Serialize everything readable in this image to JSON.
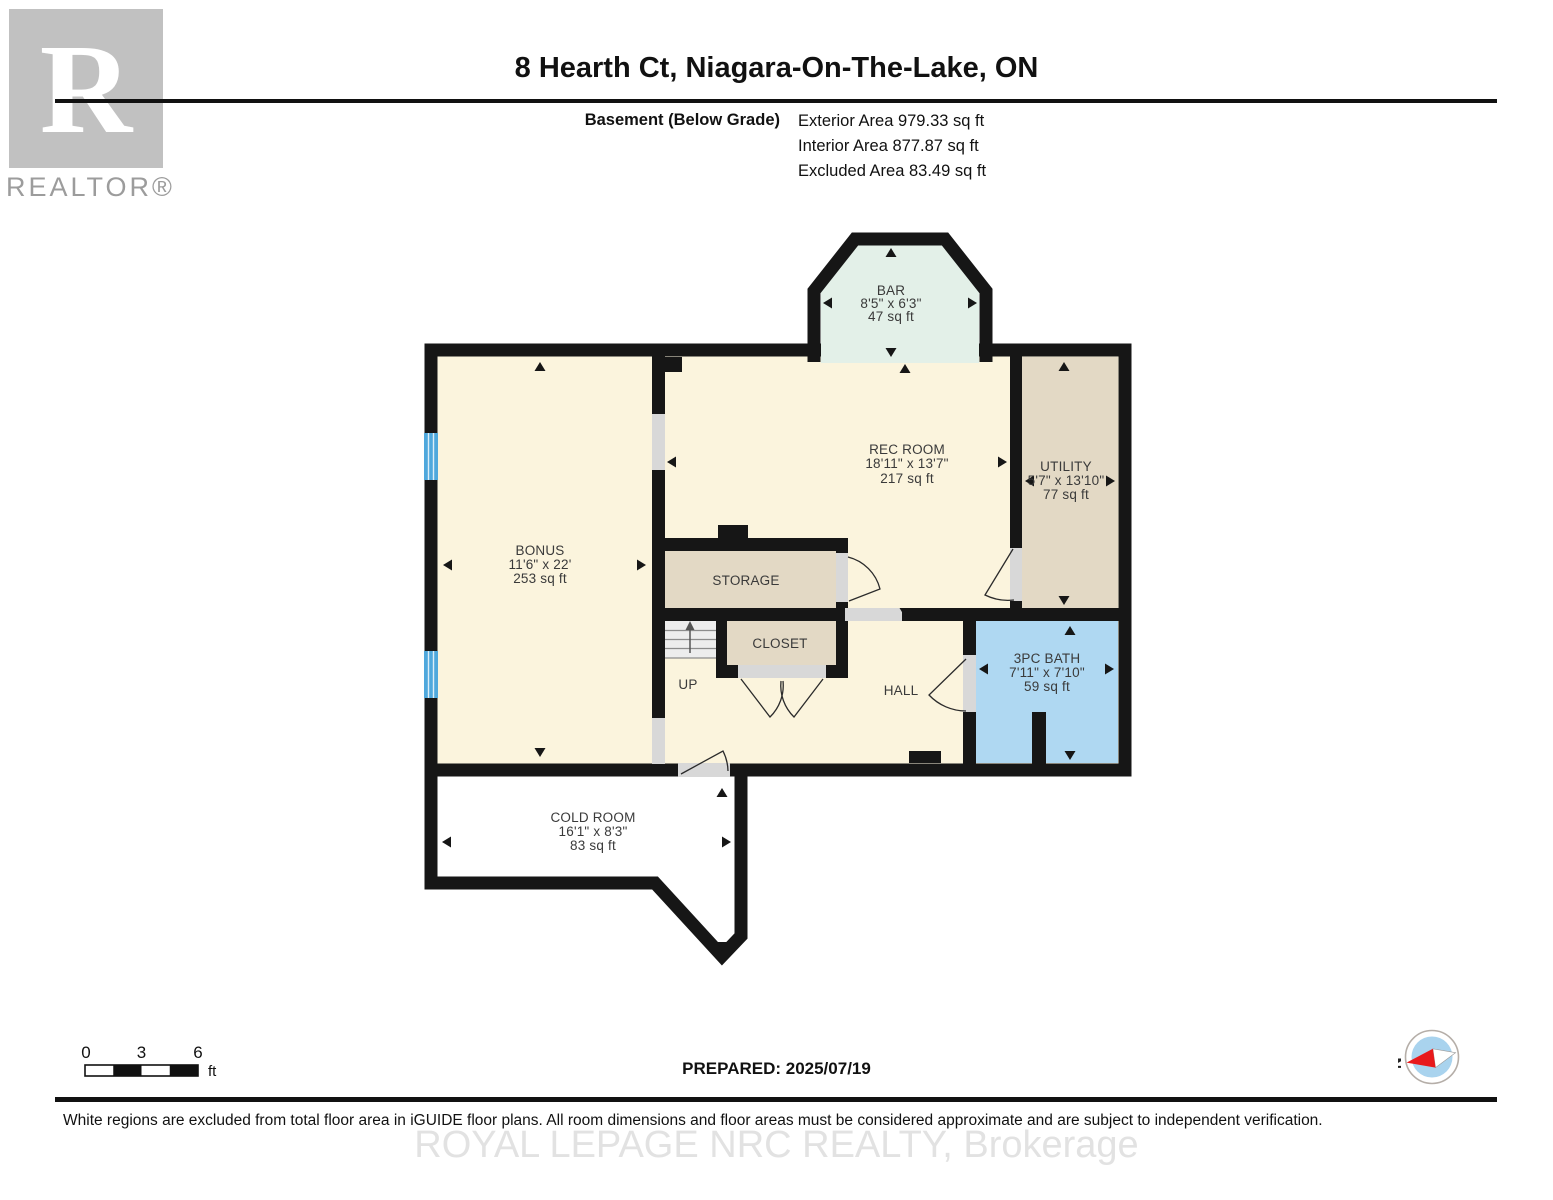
{
  "header": {
    "logo": {
      "letter": "R",
      "brand": "REALTOR®"
    },
    "title": "8 Hearth Ct, Niagara-On-The-Lake, ON",
    "floor_label": "Basement (Below Grade)",
    "area_lines": [
      "Exterior Area 979.33 sq ft",
      "Interior Area 877.87 sq ft",
      "Excluded Area 83.49 sq ft"
    ]
  },
  "rooms": {
    "bar": {
      "name": "BAR",
      "dims": "8'5\" x 6'3\"",
      "area": "47 sq ft"
    },
    "rec": {
      "name": "REC ROOM",
      "dims": "18'11\" x 13'7\"",
      "area": "217 sq ft"
    },
    "utility": {
      "name": "UTILITY",
      "dims": "5'7\" x 13'10\"",
      "area": "77 sq ft"
    },
    "bonus": {
      "name": "BONUS",
      "dims": "11'6\" x 22'",
      "area": "253 sq ft"
    },
    "storage": {
      "name": "STORAGE"
    },
    "closet": {
      "name": "CLOSET"
    },
    "hall": {
      "name": "HALL"
    },
    "stairs": {
      "label": "UP"
    },
    "bath": {
      "name": "3PC BATH",
      "dims": "7'11\" x 7'10\"",
      "area": "59 sq ft"
    },
    "cold": {
      "name": "COLD ROOM",
      "dims": "16'1\" x 8'3\"",
      "area": "83 sq ft"
    }
  },
  "footer": {
    "scale": {
      "ticks": [
        "0",
        "3",
        "6"
      ],
      "unit": "ft"
    },
    "prepared": "PREPARED: 2025/07/19",
    "compass": {
      "north": "N"
    },
    "disclaimer": "White regions are excluded from total floor area in iGUIDE floor plans. All room dimensions and floor areas must be considered approximate and are subject to independent verification.",
    "watermark": "ROYAL LEPAGE NRC REALTY, Brokerage"
  },
  "colors": {
    "wall": "#161616",
    "cream": "#FBF4DD",
    "tan": "#E3D9C5",
    "mint": "#E3F0E8",
    "bath_blue": "#AFD8F2",
    "window_blue": "#4FA8DC",
    "opening_gray": "#D8D8D8"
  }
}
